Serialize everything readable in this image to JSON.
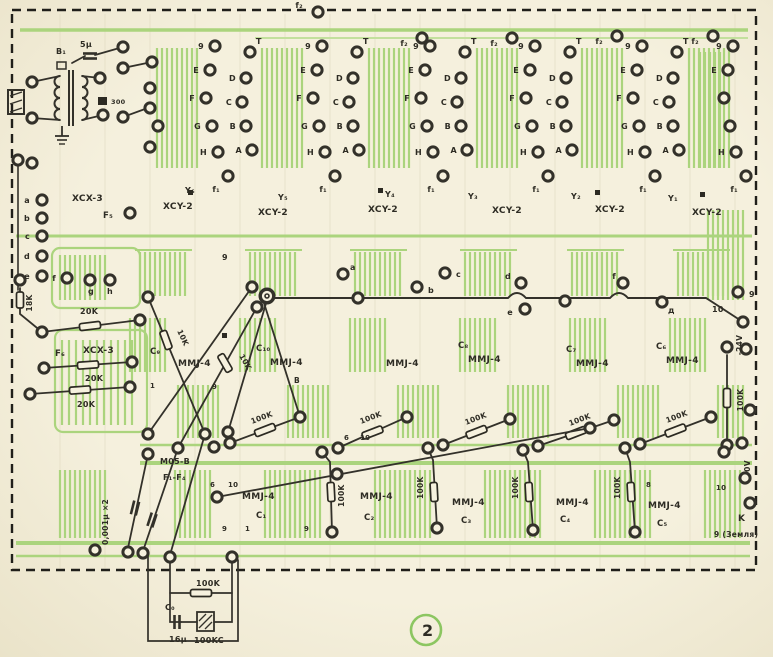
{
  "figure": {
    "number": "2"
  },
  "board": {
    "top_feeds": [
      "f₂",
      "f₂",
      "f₂",
      "f₂",
      "f₂"
    ],
    "column_groups": {
      "left_labels": [
        "9",
        "E",
        "F",
        "G",
        "H",
        "f₁"
      ],
      "right_labels": [
        "T",
        "D",
        "C",
        "B",
        "A"
      ]
    },
    "xcy_units": [
      {
        "ref": "Y₆",
        "part": "XCY-2"
      },
      {
        "ref": "Y₅",
        "part": "XCY-2"
      },
      {
        "ref": "Y₄",
        "part": "XCY-2"
      },
      {
        "ref": "Y₃",
        "part": "XCY-2"
      },
      {
        "ref": "Y₂",
        "part": "XCY-2"
      },
      {
        "ref": "Y₁",
        "part": "XCY-2"
      }
    ],
    "input": {
      "transformer": "В₁",
      "cap": "5μ",
      "res": "300"
    },
    "xcx_connectors": [
      {
        "ref": "F₅",
        "part": "XCX-3",
        "pins": [
          "a",
          "b",
          "c",
          "d",
          "e",
          "f",
          "g",
          "h"
        ]
      },
      {
        "ref": "F₆",
        "part": "XCX-3",
        "resistors": [
          "20K",
          "20K",
          "20K"
        ],
        "edge_res": "18K"
      }
    ],
    "bus_points": [
      "9",
      "a",
      "b",
      "c",
      "d",
      "e",
      "f",
      "д",
      "10",
      "9"
    ],
    "upper_units": [
      {
        "cap": "С₉",
        "part": "MMJ-4",
        "res": "10K"
      },
      {
        "cap": "С₁₀",
        "part": "MMJ-4",
        "res": "10K"
      },
      {
        "cap": "",
        "part": "MMJ-4"
      },
      {
        "cap": "С₈",
        "part": "MMJ-4"
      },
      {
        "cap": "С₇",
        "part": "MMJ-4"
      },
      {
        "cap": "С₆",
        "part": "MMJ-4"
      }
    ],
    "coupling_resistors": [
      "100K",
      "100K",
      "100K",
      "100K",
      "100K"
    ],
    "lower_units": [
      {
        "cap": "С₁",
        "part": "MMJ-4"
      },
      {
        "cap": "С₂",
        "part": "MMJ-4",
        "res": "100K"
      },
      {
        "cap": "С₃",
        "part": "MMJ-4",
        "res": "100K"
      },
      {
        "cap": "С₄",
        "part": "MMJ-4",
        "res": "100K"
      },
      {
        "cap": "С₅",
        "part": "MMJ-4",
        "res": "100K"
      }
    ],
    "filter_unit": {
      "part": "M05-B",
      "range": "F₁-F₄",
      "caps": "0,001μ ×2"
    },
    "power": {
      "supply": "-24V",
      "supply_res": "100K",
      "zero": "0V",
      "terminal_k": "K",
      "ground": "9 (Земля)",
      "pin10": "10",
      "pin9": "9"
    },
    "external": {
      "res": "100K",
      "cap_ref": "С₀",
      "cap_val": "16μ",
      "block": "100KC"
    },
    "pad_numbers": {
      "n1": "1",
      "n6": "6",
      "n8": "8",
      "n9": "9",
      "n10": "10",
      "nB": "В"
    }
  }
}
